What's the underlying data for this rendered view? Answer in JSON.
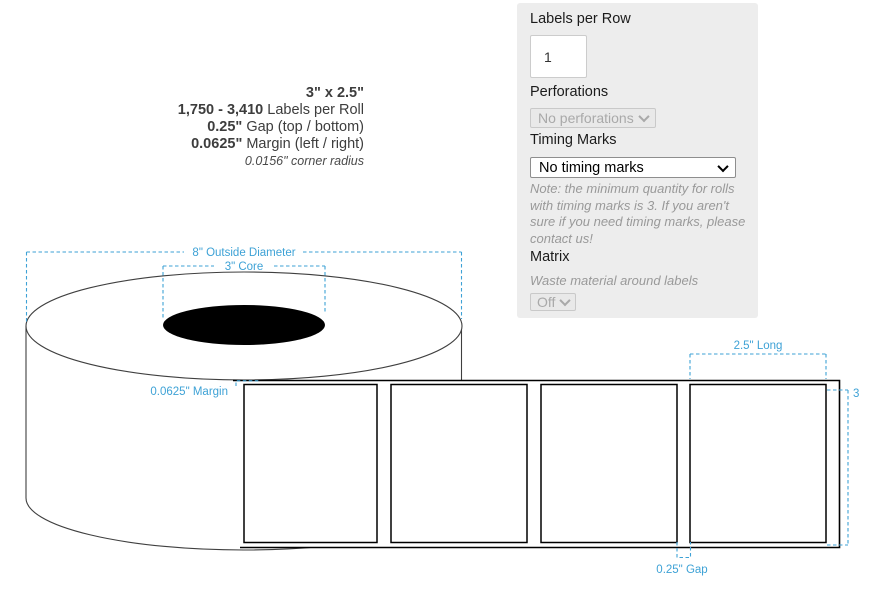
{
  "specs": {
    "size": "3\" x 2.5\"",
    "rolls_range": "1,750 - 3,410",
    "rolls_label": " Labels per Roll",
    "gap_value": "0.25\"",
    "gap_label": " Gap (top / bottom)",
    "margin_value": "0.0625\"",
    "margin_label": " Margin (left / right)",
    "corner_radius": "0.0156\" corner radius"
  },
  "panel": {
    "labels_per_row_label": "Labels per Row",
    "labels_per_row_value": "1",
    "perforations_label": "Perforations",
    "perforations_value": "No perforations",
    "timing_marks_label": "Timing Marks",
    "timing_marks_value": "No timing marks",
    "timing_note": "Note: the minimum quantity for rolls with timing marks is 3. If you aren't sure if you need timing marks, please contact us!",
    "matrix_label": "Matrix",
    "matrix_description": "Waste material around labels",
    "matrix_value": "Off"
  },
  "diagram": {
    "outside_diameter": "8\" Outside Diameter",
    "core": "3\" Core",
    "margin": "0.0625\" Margin",
    "label_length": "2.5\" Long",
    "label_width": "3",
    "gap": "0.25\" Gap",
    "accent_color": "#3EA2D6"
  }
}
